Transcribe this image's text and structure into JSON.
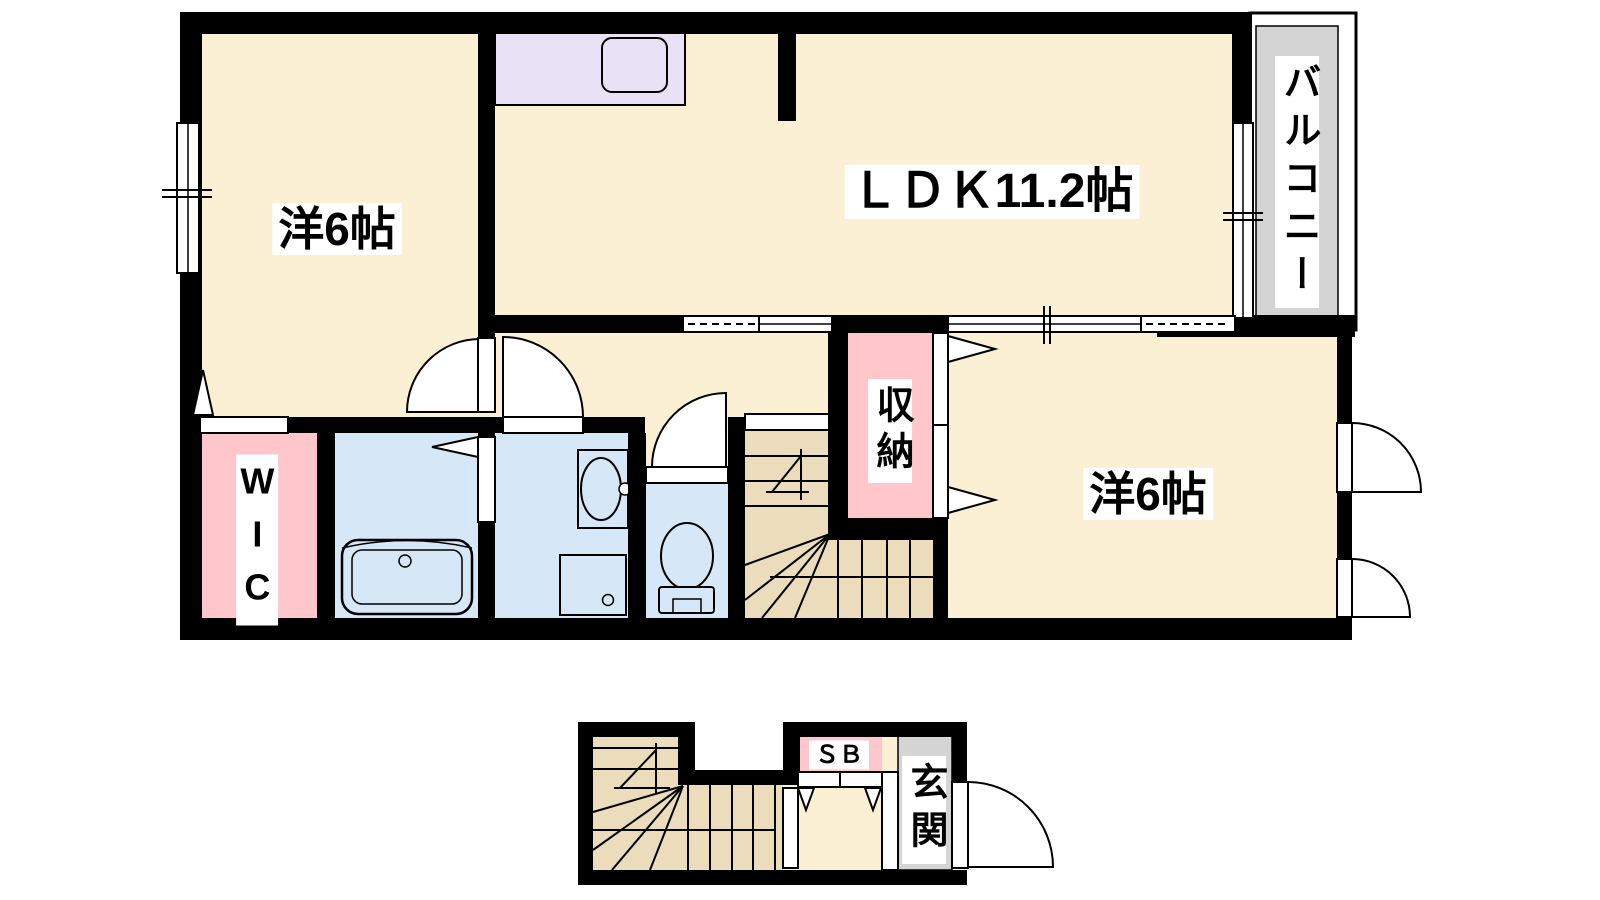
{
  "plan": {
    "second_floor": {
      "bedroom_left": "洋6帖",
      "ldk": "ＬＤＫ11.2帖",
      "balcony": "バルコニー",
      "storage": "収納",
      "bedroom_right": "洋6帖",
      "walk_in_closet": "WIC"
    },
    "first_floor": {
      "shoe_box": "ＳＢ",
      "entrance": "玄関"
    },
    "colors": {
      "wall": "#000000",
      "room_floor": "#FCF0D4",
      "stairs_floor": "#EBDCBB",
      "wet_area_floor": "#D6E7F8",
      "closet_pink": "#FFC6CB",
      "kitchen_counter": "#E9E1F5",
      "balcony_gray": "#D4D4D4"
    }
  }
}
